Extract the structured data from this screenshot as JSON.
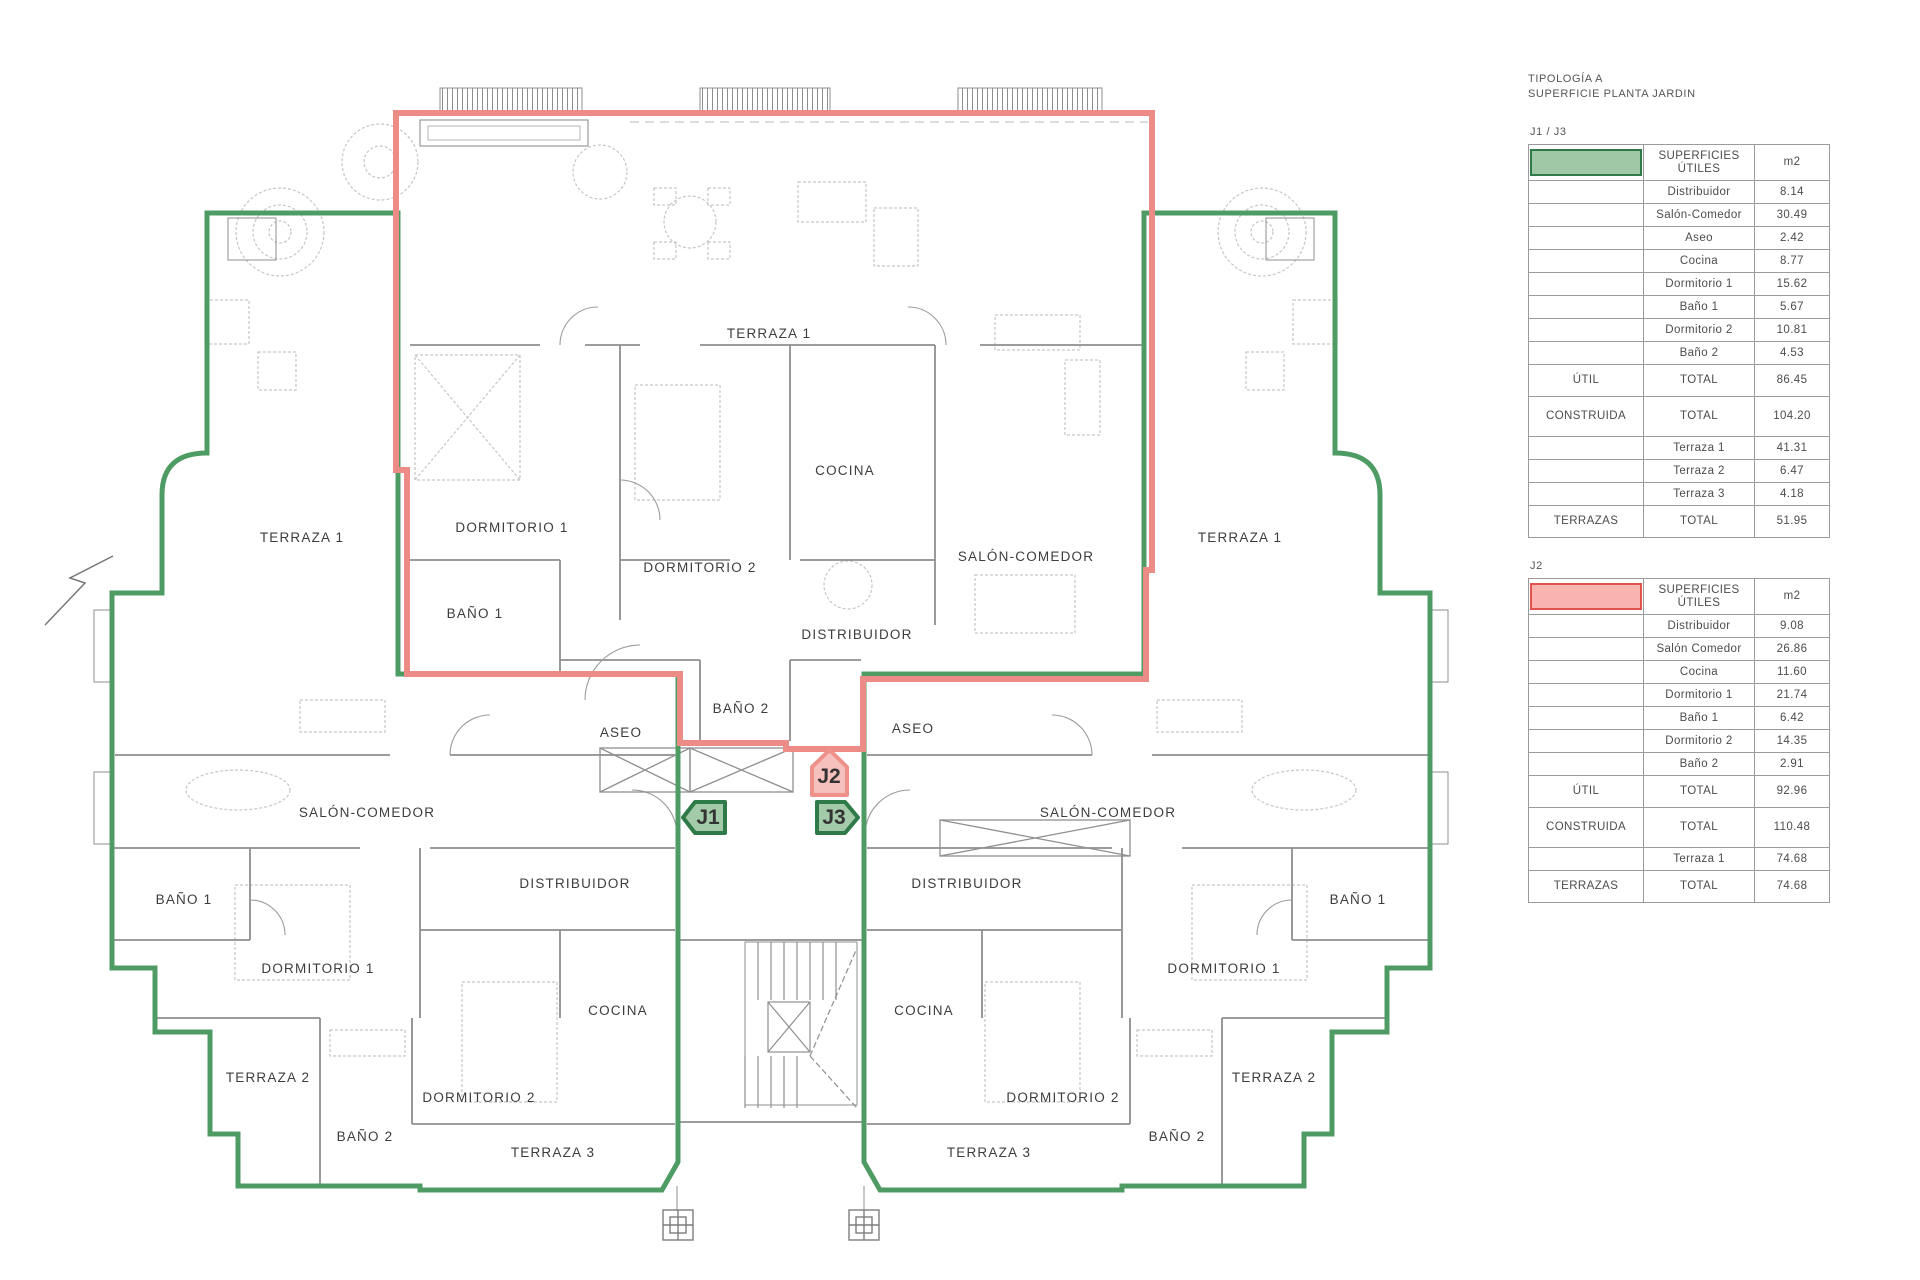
{
  "sidebar_title": {
    "line1": "TIPOLOGÍA A",
    "line2": "SUPERFICIE PLANTA JARDIN"
  },
  "colors": {
    "unit_green_outline": "#4f9b64",
    "unit_red_outline": "#ed8c86",
    "swatch_green": "#a0c8a7",
    "swatch_green_border": "#2f7a49",
    "swatch_red": "#f9b4b0",
    "swatch_red_border": "#e2524e"
  },
  "tables": [
    {
      "section": "J1 / J3",
      "swatch": "green-swatch",
      "header_label": "SUPERFICIES ÚTILES",
      "unit_label": "m2",
      "rows": [
        {
          "label": "Distribuidor",
          "value": "8.14"
        },
        {
          "label": "Salón-Comedor",
          "value": "30.49"
        },
        {
          "label": "Aseo",
          "value": "2.42"
        },
        {
          "label": "Cocina",
          "value": "8.77"
        },
        {
          "label": "Dormitorio 1",
          "value": "15.62"
        },
        {
          "label": "Baño 1",
          "value": "5.67"
        },
        {
          "label": "Dormitorio 2",
          "value": "10.81"
        },
        {
          "label": "Baño 2",
          "value": "4.53"
        }
      ],
      "util": {
        "name": "ÚTIL",
        "label": "TOTAL",
        "value": "86.45"
      },
      "construida": {
        "name": "CONSTRUIDA",
        "label": "TOTAL",
        "value": "104.20"
      },
      "terrace_rows": [
        {
          "label": "Terraza 1",
          "value": "41.31"
        },
        {
          "label": "Terraza 2",
          "value": "6.47"
        },
        {
          "label": "Terraza 3",
          "value": "4.18"
        }
      ],
      "terrazas": {
        "name": "TERRAZAS",
        "label": "TOTAL",
        "value": "51.95"
      }
    },
    {
      "section": "J2",
      "swatch": "red-swatch",
      "header_label": "SUPERFICIES ÚTILES",
      "unit_label": "m2",
      "rows": [
        {
          "label": "Distribuidor",
          "value": "9.08"
        },
        {
          "label": "Salón Comedor",
          "value": "26.86"
        },
        {
          "label": "Cocina",
          "value": "11.60"
        },
        {
          "label": "Dormitorio 1",
          "value": "21.74"
        },
        {
          "label": "Baño 1",
          "value": "6.42"
        },
        {
          "label": "Dormitorio 2",
          "value": "14.35"
        },
        {
          "label": "Baño 2",
          "value": "2.91"
        }
      ],
      "util": {
        "name": "ÚTIL",
        "label": "TOTAL",
        "value": "92.96"
      },
      "construida": {
        "name": "CONSTRUIDA",
        "label": "TOTAL",
        "value": "110.48"
      },
      "terrace_rows": [
        {
          "label": "Terraza 1",
          "value": "74.68"
        }
      ],
      "terrazas": {
        "name": "TERRAZAS",
        "label": "TOTAL",
        "value": "74.68"
      }
    }
  ],
  "plan": {
    "badges": [
      {
        "id": "J1"
      },
      {
        "id": "J2"
      },
      {
        "id": "J3"
      }
    ],
    "labels": [
      {
        "text": "TERRAZA 1"
      },
      {
        "text": "TERRAZA 1"
      },
      {
        "text": "TERRAZA 1"
      },
      {
        "text": "DORMITORIO 1"
      },
      {
        "text": "DORMITORIO 2"
      },
      {
        "text": "COCINA"
      },
      {
        "text": "SALÓN-COMEDOR"
      },
      {
        "text": "BAÑO 1"
      },
      {
        "text": "DISTRIBUIDOR"
      },
      {
        "text": "BAÑO 2"
      },
      {
        "text": "ASEO"
      },
      {
        "text": "ASEO"
      },
      {
        "text": "SALÓN-COMEDOR"
      },
      {
        "text": "SALÓN-COMEDOR"
      },
      {
        "text": "BAÑO 1"
      },
      {
        "text": "BAÑO 1"
      },
      {
        "text": "DISTRIBUIDOR"
      },
      {
        "text": "DISTRIBUIDOR"
      },
      {
        "text": "DORMITORIO 1"
      },
      {
        "text": "DORMITORIO 1"
      },
      {
        "text": "COCINA"
      },
      {
        "text": "COCINA"
      },
      {
        "text": "TERRAZA 2"
      },
      {
        "text": "TERRAZA 2"
      },
      {
        "text": "DORMITORIO 2"
      },
      {
        "text": "DORMITORIO 2"
      },
      {
        "text": "BAÑO 2"
      },
      {
        "text": "BAÑO 2"
      },
      {
        "text": "TERRAZA 3"
      },
      {
        "text": "TERRAZA 3"
      }
    ]
  }
}
